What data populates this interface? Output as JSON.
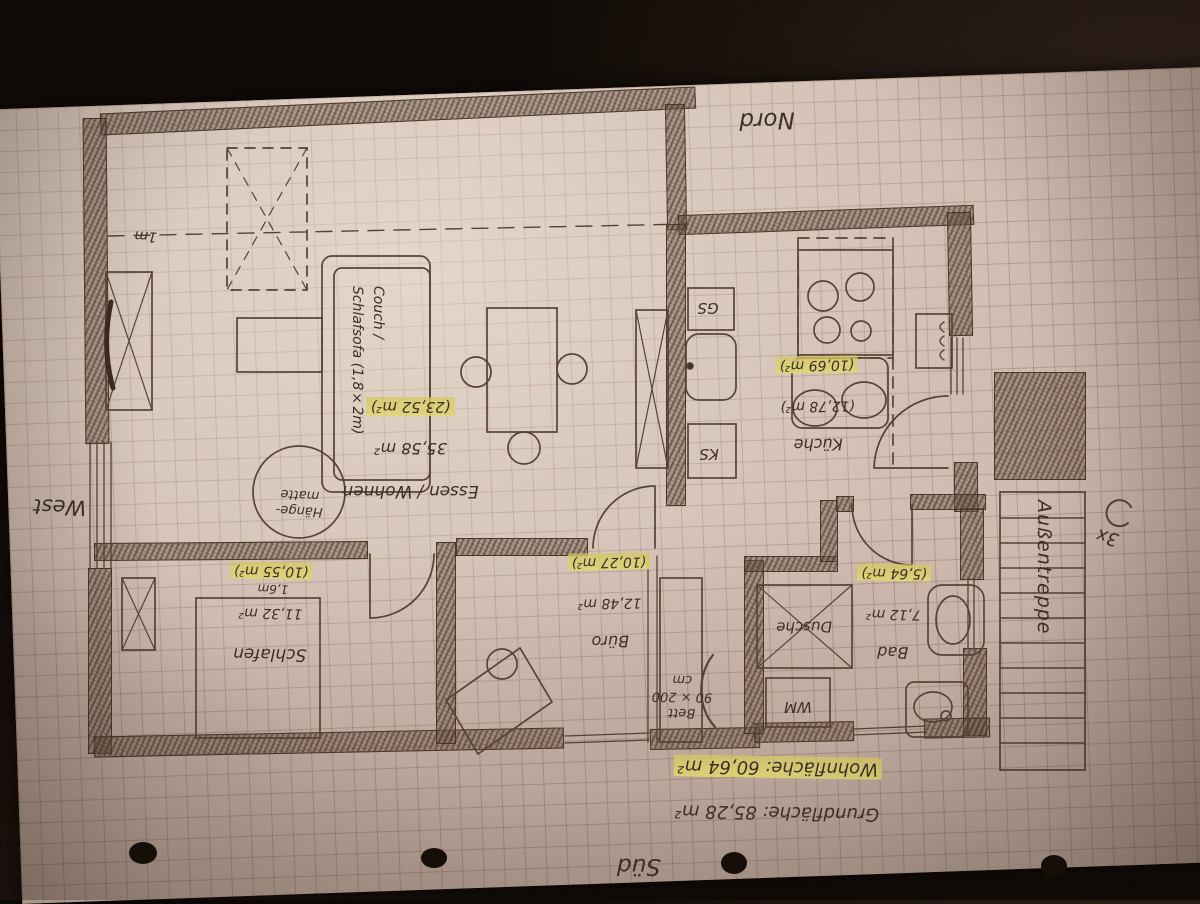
{
  "compass": {
    "north": "Nord",
    "south": "Süd",
    "west": "West"
  },
  "summary": {
    "grund": "Grundfläche: 85,28 m²",
    "wohn": "Wohnfläche: 60,64 m²"
  },
  "rooms": {
    "wohnen": {
      "name": "Essen / Wohnen",
      "gross": "35,58 m²",
      "net": "(23,52 m²)"
    },
    "kueche": {
      "name": "Küche",
      "gross": "(12,78 m²)",
      "net": "(10,69 m²)"
    },
    "bad": {
      "name": "Bad",
      "gross": "7,12 m²",
      "net": "(5,64 m²)"
    },
    "buero": {
      "name": "Büro",
      "gross": "12,48 m²",
      "net": "(10,27 m²)"
    },
    "schlafen": {
      "name": "Schlafen",
      "gross": "11,32 m²",
      "net": "(10,55 m²)"
    }
  },
  "annotations": {
    "couch": "Couch /\nSchlafsofa (1,8×2m)",
    "haengematte": "Hänge-\nmatte",
    "bett": "Bett\n90 × 200 cm",
    "aussentreppe": "Außentreppe",
    "steps": "3x",
    "roof_line": "1m",
    "bed_width": "1,6m"
  },
  "appliances": {
    "gs": "GS",
    "ks": "KS",
    "wm": "WM",
    "dusche": "Dusche"
  },
  "colors": {
    "pencil": "#4d3b2f",
    "highlight": "#e6df7a",
    "paper": "#d8c5ba",
    "background": "#0e0a07"
  }
}
